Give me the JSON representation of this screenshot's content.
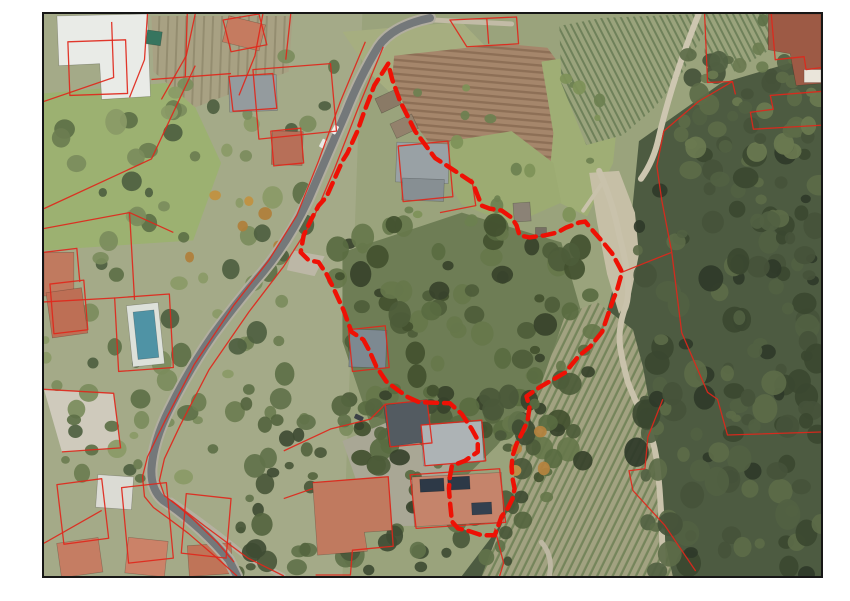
{
  "page": {
    "width": 850,
    "height": 601,
    "background": "#ffffff"
  },
  "map": {
    "frame": {
      "left": 42,
      "top": 12,
      "width": 781,
      "height": 566,
      "border_color": "#161616",
      "border_width": 2
    },
    "base_color": "#9aa37c",
    "patterns": [
      {
        "id": "fieldRows",
        "gap": 7,
        "lw": 2.4,
        "angle": 5,
        "bg": "#a5866b",
        "line": "#8d6f56"
      },
      {
        "id": "vineTR",
        "gap": 6,
        "lw": 2.0,
        "angle": 63,
        "bg": "#9aa37c",
        "line": "#6f815a"
      },
      {
        "id": "vineBR",
        "gap": 7,
        "lw": 2.3,
        "angle": 116,
        "bg": "#a2a281",
        "line": "#75855b"
      },
      {
        "id": "gardenRows",
        "gap": 9,
        "lw": 2.0,
        "angle": 92,
        "bg": "#a8a183",
        "line": "#948d70"
      }
    ],
    "terrain": [
      {
        "name": "tone-left-residential",
        "points": "0,0 320,0 300,566 0,566",
        "fill": "#a4aa88"
      },
      {
        "name": "lawn-top-left",
        "points": "0,80 140,68 178,150 150,228 0,238",
        "fill": "#9cb171"
      },
      {
        "name": "garden-plots-top-left",
        "points": "108,2 250,2 246,58 152,94 110,58",
        "fill": "pattern:gardenRows"
      },
      {
        "name": "grass-roadside",
        "points": "300,18 420,8 468,58 452,118 382,112 330,62",
        "fill": "#a6ae80"
      },
      {
        "name": "plowed-field",
        "points": "352,42 462,30 506,34 522,56 532,106 528,156 502,186 454,186 404,152 366,102 350,64",
        "fill": "pattern:fieldRows"
      },
      {
        "name": "grass-mid-east",
        "points": "500,48 562,38 578,92 572,150 546,204 506,184 512,120",
        "fill": "#9fae75"
      },
      {
        "name": "vineyard-top-right",
        "points": "518,12 560,4 656,0 664,18 640,62 612,96 582,122 545,132 520,70",
        "fill": "pattern:vineTR"
      },
      {
        "name": "crops-top-right-corner",
        "points": "664,0 742,0 733,34 694,58 664,40",
        "fill": "pattern:vineTR"
      },
      {
        "name": "forest-right",
        "points": "598,128 680,70 781,40 781,566 420,566 455,520 498,430 560,320 590,210",
        "fill": "#4d5b41"
      },
      {
        "name": "woods-center-parcel",
        "points": "300,240 420,200 520,230 540,300 500,380 455,435 420,470 378,470 330,420 300,330",
        "fill": "#6e7d55"
      },
      {
        "name": "vineyard-bottom-right",
        "points": "498,378 524,303 556,290 592,318 602,355 610,400 617,459 622,520 632,566 440,566 455,526 466,500 473,472 470,445 476,420 487,398",
        "fill": "pattern:vineBR"
      },
      {
        "name": "dirt-junction",
        "points": "548,160 578,158 594,200 598,242 590,282 578,302 566,262 556,210",
        "fill": "#c6bfa6"
      },
      {
        "name": "terrace-bottom-left",
        "points": "0,378 70,382 77,437 18,441",
        "fill": "#cfcabc"
      },
      {
        "name": "parking-road-bend",
        "points": "250,238 282,244 272,264 244,258",
        "fill": "#bcb7a6"
      },
      {
        "name": "yard-bottom-center",
        "points": "300,430 360,405 412,442 404,515 330,516",
        "fill": "#a9a795"
      },
      {
        "name": "lawn-parcel-north",
        "points": "408,128 470,118 512,150 520,190 470,212 420,192 400,160",
        "fill": "#9cab72"
      }
    ],
    "dirt_paths": [
      {
        "name": "track-east",
        "d": "M558,158 Q572,190 578,222 Q586,252 587,272 Q588,289 583,299 Q577,318 579,334 Q581,349 587,371 Q593,387 604,409 Q614,429 617,459 Q620,489 621,519 L622,554",
        "width": 6,
        "color": "#c9c2ab"
      },
      {
        "name": "track-fork",
        "d": "M560,172 L542,198",
        "width": 4,
        "color": "#c9c2ab"
      },
      {
        "name": "track-top-right",
        "d": "M658,0 Q646,30 636,60 Q625,94 618,124 Q613,148 600,166",
        "width": 6,
        "color": "#cdc6b0"
      },
      {
        "name": "track-top-edge",
        "d": "M390,6 L470,10",
        "width": 5,
        "color": "#c2bba6"
      },
      {
        "name": "track-south",
        "d": "M500,532 Q512,546 508,566",
        "width": 5,
        "color": "#bdb7a2"
      },
      {
        "name": "track-bottom-left",
        "d": "M128,490 Q165,515 205,548 L240,566",
        "width": 6,
        "color": "#b5b1a0"
      }
    ],
    "tree_clusters": [
      {
        "name": "forest-right",
        "x": 595,
        "y": 128,
        "w": 186,
        "h": 438,
        "count": 150,
        "rmin": 5,
        "rmax": 13,
        "palette": [
          "#3b4830",
          "#45533a",
          "#516142",
          "#2f3a29",
          "#5c6b48"
        ]
      },
      {
        "name": "forest-ne",
        "x": 640,
        "y": 40,
        "w": 141,
        "h": 100,
        "count": 45,
        "rmin": 5,
        "rmax": 11,
        "palette": [
          "#45533a",
          "#516142",
          "#5c6b48",
          "#6a7a50"
        ]
      },
      {
        "name": "woods-center",
        "x": 292,
        "y": 212,
        "w": 266,
        "h": 296,
        "count": 130,
        "rmin": 5,
        "rmax": 12,
        "palette": [
          "#42502f",
          "#4d5c3a",
          "#596b41",
          "#37422b",
          "#66774b"
        ]
      },
      {
        "name": "trees-left-band",
        "x": 0,
        "y": 40,
        "w": 305,
        "h": 430,
        "count": 100,
        "rmin": 4,
        "rmax": 11,
        "palette": [
          "#5d7046",
          "#6b7d50",
          "#7b8c5c",
          "#4e6040",
          "#8a9a66"
        ]
      },
      {
        "name": "trees-bottom",
        "x": 195,
        "y": 385,
        "w": 290,
        "h": 178,
        "count": 80,
        "rmin": 4,
        "rmax": 11,
        "palette": [
          "#4a583a",
          "#55653f",
          "#61724a",
          "#3f4c33"
        ]
      },
      {
        "name": "bushes-field",
        "x": 360,
        "y": 60,
        "w": 200,
        "h": 150,
        "count": 20,
        "rmin": 3,
        "rmax": 7,
        "palette": [
          "#7e9158",
          "#6d8050"
        ]
      },
      {
        "name": "garden-ne-bldg",
        "x": 718,
        "y": 2,
        "w": 60,
        "h": 58,
        "count": 10,
        "rmin": 4,
        "rmax": 8,
        "palette": [
          "#5d7046",
          "#6b7d50"
        ]
      },
      {
        "name": "autumn-left",
        "x": 120,
        "y": 130,
        "w": 120,
        "h": 120,
        "count": 6,
        "rmin": 4,
        "rmax": 7,
        "palette": [
          "#c1913f",
          "#b07f3a"
        ]
      },
      {
        "name": "autumn-center",
        "x": 460,
        "y": 420,
        "w": 60,
        "h": 40,
        "count": 4,
        "rmin": 4,
        "rmax": 7,
        "palette": [
          "#b5823e",
          "#c49348"
        ]
      }
    ],
    "buildings": [
      {
        "name": "white-building-top-left",
        "poly": "13,2 104,0 107,83 58,86 56,50 15,52",
        "fill": "#e9ebe7"
      },
      {
        "name": "house-salmon-top",
        "x": 182,
        "y": 6,
        "w": 38,
        "h": 27,
        "rot": 14,
        "fill": "#c57b60"
      },
      {
        "name": "villa-gray-roof",
        "x": 186,
        "y": 62,
        "w": 48,
        "h": 36,
        "rot": -2,
        "fill": "#949b9e"
      },
      {
        "name": "house-salmon-left",
        "x": 229,
        "y": 118,
        "w": 31,
        "h": 34,
        "rot": 2,
        "fill": "#b76f58"
      },
      {
        "name": "greenhouse",
        "x": 103,
        "y": 17,
        "w": 15,
        "h": 14,
        "rot": 8,
        "fill": "#37755f"
      },
      {
        "name": "building-top-right",
        "poly": "728,0 781,0 781,70 756,72 750,40 728,36",
        "fill": "#9d5a45"
      },
      {
        "name": "annex-white-tr",
        "x": 764,
        "y": 56,
        "w": 17,
        "h": 13,
        "rot": 0,
        "fill": "#eae5da"
      },
      {
        "name": "house-left-edge-a",
        "x": 0,
        "y": 240,
        "w": 30,
        "h": 44,
        "rot": 0,
        "fill": "#c07a5f"
      },
      {
        "name": "house-left-edge-b",
        "x": 5,
        "y": 278,
        "w": 36,
        "h": 46,
        "rot": -8,
        "fill": "#bd6f55"
      },
      {
        "name": "pool-deck",
        "x": 86,
        "y": 292,
        "w": 32,
        "h": 62,
        "rot": -6,
        "fill": "#dde1da"
      },
      {
        "name": "swimming-pool",
        "x": 92,
        "y": 299,
        "w": 21,
        "h": 48,
        "rot": -6,
        "fill": "#4f93a5"
      },
      {
        "name": "shed-roadside-a",
        "x": 335,
        "y": 80,
        "w": 22,
        "h": 16,
        "rot": -25,
        "fill": "#8a7a66"
      },
      {
        "name": "shed-roadside-b",
        "x": 350,
        "y": 105,
        "w": 24,
        "h": 16,
        "rot": -25,
        "fill": "#93816c"
      },
      {
        "name": "villa-in-parcel",
        "x": 354,
        "y": 130,
        "w": 53,
        "h": 40,
        "rot": 2,
        "fill": "#99a1a5"
      },
      {
        "name": "villa-wing",
        "x": 360,
        "y": 166,
        "w": 42,
        "h": 22,
        "rot": 2,
        "fill": "#878f93"
      },
      {
        "name": "shed-north",
        "x": 472,
        "y": 190,
        "w": 17,
        "h": 19,
        "rot": -4,
        "fill": "#8b8276"
      },
      {
        "name": "shed-north-small",
        "x": 494,
        "y": 215,
        "w": 11,
        "h": 9,
        "rot": 0,
        "fill": "#776f64"
      },
      {
        "name": "house-mid-gray",
        "x": 307,
        "y": 318,
        "w": 37,
        "h": 38,
        "rot": 2,
        "fill": "#7d8991"
      },
      {
        "name": "house-dark-roof",
        "x": 344,
        "y": 391,
        "w": 44,
        "h": 42,
        "rot": -8,
        "fill": "#535b61"
      },
      {
        "name": "house-concrete",
        "x": 380,
        "y": 412,
        "w": 61,
        "h": 41,
        "rot": -4,
        "fill": "#adb3b5"
      },
      {
        "name": "house-solar",
        "x": 371,
        "y": 464,
        "w": 90,
        "h": 50,
        "rot": -3,
        "fill": "#c5846b"
      },
      {
        "name": "solar-panel-a",
        "x": 378,
        "y": 468,
        "w": 24,
        "h": 13,
        "rot": -3,
        "fill": "#2d3947"
      },
      {
        "name": "solar-panel-b",
        "x": 406,
        "y": 466,
        "w": 22,
        "h": 13,
        "rot": -3,
        "fill": "#2d3947"
      },
      {
        "name": "solar-panel-c",
        "x": 430,
        "y": 492,
        "w": 20,
        "h": 12,
        "rot": -3,
        "fill": "#33404f"
      },
      {
        "name": "house-l-shape",
        "poly": "270,472 346,466 350,520 322,522 325,541 275,545",
        "fill": "#c07a5f"
      },
      {
        "name": "house-bl-white",
        "x": 53,
        "y": 465,
        "w": 36,
        "h": 33,
        "rot": 4,
        "fill": "#dbdbd4"
      },
      {
        "name": "house-bl-a",
        "x": 15,
        "y": 530,
        "w": 42,
        "h": 35,
        "rot": -8,
        "fill": "#c57d63"
      },
      {
        "name": "house-bl-b",
        "x": 83,
        "y": 529,
        "w": 40,
        "h": 36,
        "rot": 6,
        "fill": "#cb8268"
      },
      {
        "name": "house-bl-c",
        "x": 145,
        "y": 534,
        "w": 44,
        "h": 31,
        "rot": -4,
        "fill": "#bf7458"
      }
    ],
    "roads": [
      {
        "name": "main-road",
        "d": "M388,4 Q350,12 336,33 Q318,62 303,100 Q285,142 266,186 Q247,227 220,260 Q195,289 170,323 Q145,359 126,398 Q110,430 108,458 Q107,479 120,490 Q137,501 158,520 Q174,535 186,550 L194,566",
        "casing_width": 12,
        "casing_color": "#b2aea0",
        "width": 8,
        "color": "#74787a"
      }
    ],
    "cars": [
      {
        "name": "car-white-1",
        "x": 288,
        "y": 114,
        "w": 9,
        "h": 5,
        "rot": -62,
        "fill": "#f0f1ee"
      },
      {
        "name": "car-white-2",
        "x": 276,
        "y": 128,
        "w": 9,
        "h": 5,
        "rot": -62,
        "fill": "#e8e9e6"
      },
      {
        "name": "car-dark",
        "x": 312,
        "y": 404,
        "w": 9,
        "h": 5,
        "rot": 25,
        "fill": "#3c4146"
      }
    ],
    "cadastral": {
      "color": "#e0271b",
      "width": 1.3,
      "opacity": 0.92,
      "lines": [
        "M323,28 L298,88 L276,148 L254,203 L226,248 L191,293 L151,353 L121,411 L104,446 L99,466 L101,486 L110,497 L125,508 L145,523 L174,548 L194,566",
        "M341,33 L316,94 L292,156 L269,210 L241,254 L206,300 L166,358 L137,414 L121,448 L116,470 L121,485 L134,495 L149,508 L174,532 L191,552",
        "M128,490 L162,516 L205,548 L241,566",
        "M24,28 L82,26 L84,80 L26,82 Z",
        "M0,88 L70,64 L68,8",
        "M104,0 L101,46 L86,84",
        "M152,0 L143,42 L118,86",
        "M0,196 L108,146 L152,52",
        "M180,6 L216,0 L224,31 L188,38 Z",
        "M220,0 L212,42 L196,82",
        "M210,56 L288,50 L294,118 L216,126 Z",
        "M186,63 L230,60 L234,95 L190,98 Z",
        "M144,0 L142,64 M108,66 L188,60 M248,0 L243,46",
        "M228,118 L258,115 L261,150 L231,153 Z",
        "M0,216 L86,200 L130,220 M86,200 L91,288 M0,290 L71,286",
        "M71,286 L126,282 L130,356 L75,360 Z",
        "M6,272 L40,268 L44,318 L10,322 Z M0,240 L33,236 L36,270",
        "M0,378 L70,382 L77,437 L18,441",
        "M13,474 L58,468 L65,528 L20,534 Z",
        "M78,477 L123,472 L130,548 L85,553 Z",
        "M143,483 L188,488 L183,548 L138,543 Z",
        "M0,533 L58,500",
        "M343,393 L385,389 L390,432 L348,436 Z",
        "M379,414 L440,409 L444,450 L383,455 Z",
        "M368,464 L458,458 L464,512 L374,518 Z",
        "M270,472 L346,466 L351,536 L310,540 L308,565 L273,565",
        "M241,440 L288,418 L328,408 L343,393 M241,488 L270,478",
        "M408,6 L475,3 L477,30 L425,33 Z M445,4 L447,30",
        "M664,0 L667,69 L692,68 L695,81",
        "M692,68 L658,88 L623,118 L616,153 L621,188 L631,240",
        "M631,240 L641,321 L667,381 L677,388 L687,424 L781,421",
        "M581,260 L631,240",
        "M731,0 L735,46 L764,43 L766,56 L781,54",
        "M781,78 L730,82 L733,96 L710,99 L713,116 L781,112",
        "M622,388 L607,426 L604,458 L588,460 L592,480 L624,515 L655,561",
        "M306,318 L343,314 L347,356 L310,360 Z",
        "M356,133 L406,128 L411,184 L361,189 Z",
        "M398,200 L434,193 L430,166",
        "M453,518 L462,553 L458,566"
      ]
    },
    "subject_parcel": {
      "color": "#ee1105",
      "width": 4.5,
      "dash": "12 7",
      "points": "346,50 339,61 332,72 322,98 315,118 305,140 300,148 284,184 276,193 268,208 261,223 258,240 266,248 276,250 284,262 290,274 301,298 309,320 321,328 327,339 334,355 344,370 356,379 366,386 377,391 408,392 420,403 430,418 436,429 436,441 423,450 410,455 408,466 407,478 408,491 410,511 416,518 428,521 440,525 453,525 460,506 466,498 471,488 473,478 471,468 470,456 471,445 475,433 481,421 486,410 488,396 485,385 498,376 524,361 537,345 549,335 561,320 572,288 576,278 581,260 579,256 571,241 562,230 548,214 544,209 538,210 525,215 516,220 503,223 488,225 478,223 475,213 470,205 460,198 448,196 440,193 436,183 431,170 413,158 393,145 373,118 358,88 350,66"
    }
  }
}
